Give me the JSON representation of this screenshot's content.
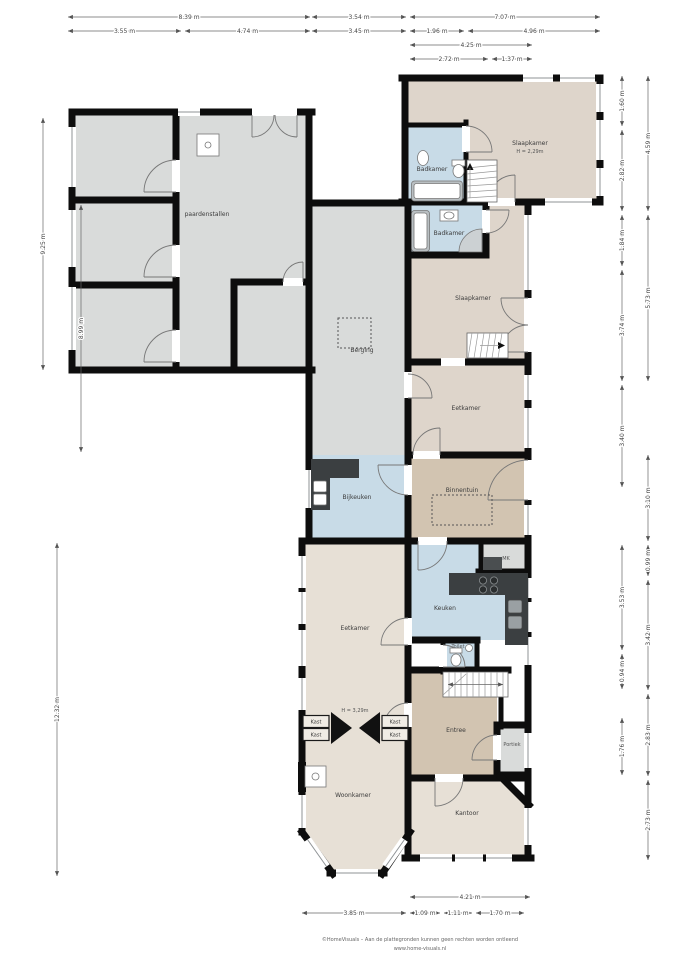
{
  "title": "Plattegrond begane grond",
  "rooms": {
    "paardenstallen": "paardenstallen",
    "berging": "Berging",
    "slaapkamer1": "Slaapkamer",
    "slaapkamer1_h": "H = 2,29m",
    "badkamer1": "Badkamer",
    "badkamer2": "Badkamer",
    "slaapkamer2": "Slaapkamer",
    "eetkamer1": "Eetkamer",
    "binnentuin": "Binnentuin",
    "bijkeuken": "Bijkeuken",
    "keuken": "Keuken",
    "mk": "MK",
    "toilet": "Toilet",
    "eetkamer2": "Eetkamer",
    "woonkamer": "Woonkamer",
    "woonkamer_h": "H = 3,29m",
    "kast": "Kast",
    "entree": "Entree",
    "portiek": "Portiek",
    "kantoor": "Kantoor"
  },
  "dims": {
    "top1": [
      "8.39 m",
      "3.54 m",
      "7.07 m"
    ],
    "top2": [
      "3.55 m",
      "4.74 m",
      "3.45 m",
      "1.96 m",
      "4.96 m"
    ],
    "top3": [
      "4.25 m"
    ],
    "top4": [
      "2.72 m",
      "1.37 m"
    ],
    "left": [
      "9.25 m",
      "8.99 m",
      "12.32 m"
    ],
    "right_inner": [
      "1.60 m",
      "2.82 m",
      "1.84 m",
      "3.74 m",
      "3.40 m",
      "3.53 m",
      "0.94 m",
      "1.76 m"
    ],
    "right_outer": [
      "4.59 m",
      "5.73 m",
      "3.10 m",
      "0.99 m",
      "3.42 m",
      "2.83 m",
      "2.73 m"
    ],
    "bottom1": [
      "4.21 m"
    ],
    "bottom2": [
      "3.85 m",
      "1.09 m",
      "1.11 m",
      "1.70 m"
    ]
  },
  "footer": {
    "line1": "©HomeVisuals – Aan de plattegronden kunnen geen rechten worden ontleend",
    "line2": "www.home-visuals.nl"
  },
  "colors": {
    "wall": "#0d0d0d",
    "gray": "#d9dbda",
    "beige": "#ded5cb",
    "beige_light": "#e7e0d6",
    "tan": "#d2c4b1",
    "blue": "#c8dbe7",
    "counter": "#3b3f41",
    "white": "#ffffff"
  }
}
